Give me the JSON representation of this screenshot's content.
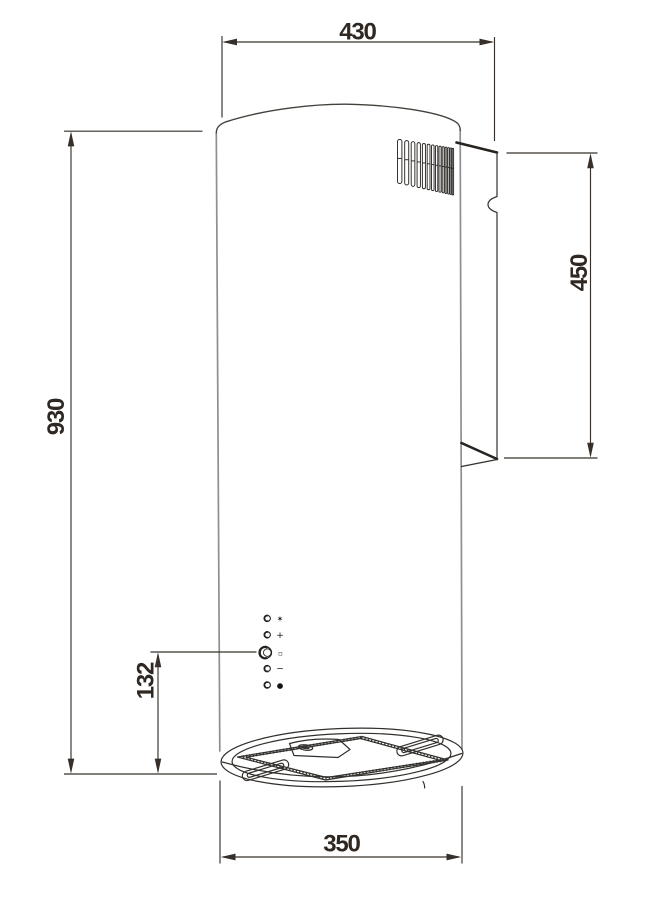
{
  "diagram": {
    "line_color": "#37302a",
    "dimensions": {
      "top_width": "430",
      "total_height": "930",
      "duct_cover_height": "450",
      "controls_to_bottom": "132",
      "body_diameter": "350"
    },
    "control_panel": {
      "buttons": [
        {
          "name": "fan-speed-icon",
          "glyph": "✶"
        },
        {
          "name": "plus-icon",
          "glyph": "+"
        },
        {
          "name": "display-icon",
          "glyph": "▫"
        },
        {
          "name": "minus-icon",
          "glyph": "−"
        },
        {
          "name": "light-icon",
          "glyph": "●"
        }
      ]
    }
  }
}
